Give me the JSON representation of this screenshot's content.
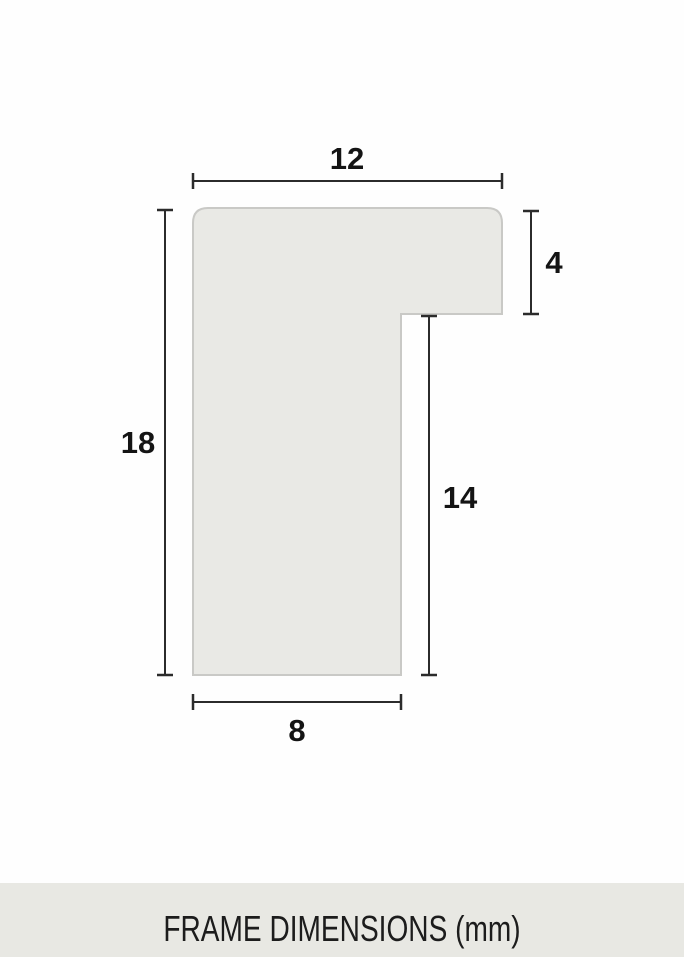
{
  "diagram": {
    "dimensions": {
      "top_width": "12",
      "left_height": "18",
      "right_lip_height": "4",
      "inner_depth": "14",
      "bottom_width": "8"
    },
    "colors": {
      "profile_fill": "#e9e9e5",
      "profile_stroke": "#c9c9c6",
      "dimension_line": "#2b2b2b",
      "label_text": "#141414",
      "footer_background": "#e8e8e3",
      "page_background": "#fefefe"
    },
    "footer_caption": "FRAME DIMENSIONS (mm)"
  }
}
